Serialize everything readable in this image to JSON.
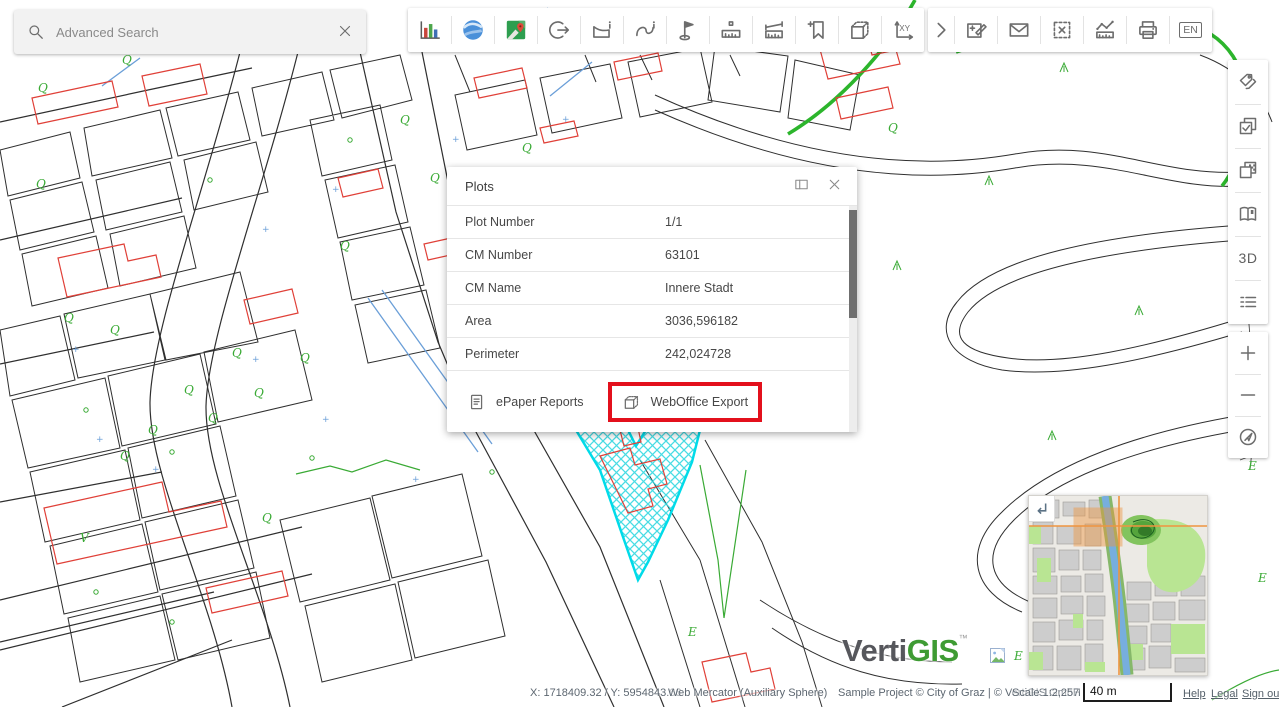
{
  "search": {
    "placeholder": "Advanced Search"
  },
  "toolbar_top": {
    "group_main_icons": [
      "statistics-chart",
      "google-earth",
      "google-maps",
      "session-exit",
      "polygon-info",
      "polyline-info",
      "set-flag",
      "measure-ruler",
      "measure-band",
      "bookmark-add",
      "box-3d",
      "coordinates-xy"
    ],
    "group_more_icons": [
      "expand",
      "redlining-edit",
      "send-mail",
      "clear-selection",
      "measure-sketch",
      "print",
      "language"
    ],
    "xy_label": "XY",
    "language_label": "EN"
  },
  "right_toolbar": {
    "icons": [
      "tags",
      "layer-check",
      "layer-transparency",
      "map-book",
      "view-3d",
      "legend",
      "zoom-in",
      "zoom-out",
      "locate"
    ],
    "threed_label": "3D"
  },
  "dialog": {
    "title": "Plots",
    "rows": [
      {
        "label": "Plot Number",
        "value": "1/1"
      },
      {
        "label": "CM Number",
        "value": "63101"
      },
      {
        "label": "CM Name",
        "value": "Innere Stadt"
      },
      {
        "label": "Area",
        "value": "3036,596182"
      },
      {
        "label": "Perimeter",
        "value": "242,024728"
      }
    ],
    "actions": {
      "epaper": "ePaper Reports",
      "export": "WebOffice Export"
    }
  },
  "statusbar": {
    "coordinates": "X: 1718409.32 / Y: 5954843.66",
    "projection": "Web Mercator (Auxiliary Sphere)",
    "copyright": "Sample Project © City of Graz | © VertiGIS GmbH",
    "scale": "Scale 1:2,257",
    "scalebar": "40 m",
    "links": [
      "Help",
      "Legal",
      "Sign out"
    ]
  },
  "logo": {
    "part1": "Verti",
    "part2": "GIS",
    "tm": "™"
  },
  "colors": {
    "highlight_box": "#e3101c",
    "selection_cyan": "#00dbe9",
    "map_green": "#3aaa35",
    "map_red": "#e04038",
    "extent_orange": "#ef9440"
  },
  "map": {
    "symbols": [
      {
        "t": "Q",
        "x": 38,
        "y": 92,
        "c": "g"
      },
      {
        "t": "Q",
        "x": 122,
        "y": 64,
        "c": "g"
      },
      {
        "t": "Q",
        "x": 36,
        "y": 188,
        "c": "g"
      },
      {
        "t": "Q",
        "x": 64,
        "y": 322,
        "c": "g"
      },
      {
        "t": "Q",
        "x": 110,
        "y": 334,
        "c": "g"
      },
      {
        "t": "Q",
        "x": 232,
        "y": 357,
        "c": "g"
      },
      {
        "t": "Q",
        "x": 184,
        "y": 394,
        "c": "g"
      },
      {
        "t": "Q",
        "x": 148,
        "y": 434,
        "c": "g"
      },
      {
        "t": "Q",
        "x": 120,
        "y": 460,
        "c": "g"
      },
      {
        "t": "Q",
        "x": 208,
        "y": 422,
        "c": "g"
      },
      {
        "t": "Q",
        "x": 254,
        "y": 397,
        "c": "g"
      },
      {
        "t": "Q",
        "x": 400,
        "y": 124,
        "c": "g"
      },
      {
        "t": "Q",
        "x": 522,
        "y": 152,
        "c": "g"
      },
      {
        "t": "Q",
        "x": 888,
        "y": 132,
        "c": "g"
      },
      {
        "t": "Q",
        "x": 340,
        "y": 250,
        "c": "g"
      },
      {
        "t": "Q",
        "x": 300,
        "y": 362,
        "c": "g"
      },
      {
        "t": "Q",
        "x": 262,
        "y": 522,
        "c": "g"
      },
      {
        "t": "Q",
        "x": 430,
        "y": 182,
        "c": "g"
      },
      {
        "t": "V",
        "x": 80,
        "y": 542,
        "c": "g"
      },
      {
        "t": "E",
        "x": 688,
        "y": 636,
        "c": "g"
      },
      {
        "t": "E",
        "x": 1014,
        "y": 660,
        "c": "g"
      },
      {
        "t": "E",
        "x": 1248,
        "y": 470,
        "c": "g"
      },
      {
        "t": "E",
        "x": 1258,
        "y": 582,
        "c": "g"
      },
      {
        "t": "+",
        "x": 72,
        "y": 352,
        "c": "b"
      },
      {
        "t": "+",
        "x": 96,
        "y": 442,
        "c": "b"
      },
      {
        "t": "+",
        "x": 152,
        "y": 472,
        "c": "b"
      },
      {
        "t": "+",
        "x": 252,
        "y": 362,
        "c": "b"
      },
      {
        "t": "+",
        "x": 322,
        "y": 422,
        "c": "b"
      },
      {
        "t": "+",
        "x": 412,
        "y": 482,
        "c": "b"
      },
      {
        "t": "+",
        "x": 332,
        "y": 192,
        "c": "b"
      },
      {
        "t": "+",
        "x": 262,
        "y": 232,
        "c": "b"
      },
      {
        "t": "+",
        "x": 452,
        "y": 142,
        "c": "b"
      },
      {
        "t": "+",
        "x": 562,
        "y": 122,
        "c": "b"
      }
    ]
  }
}
